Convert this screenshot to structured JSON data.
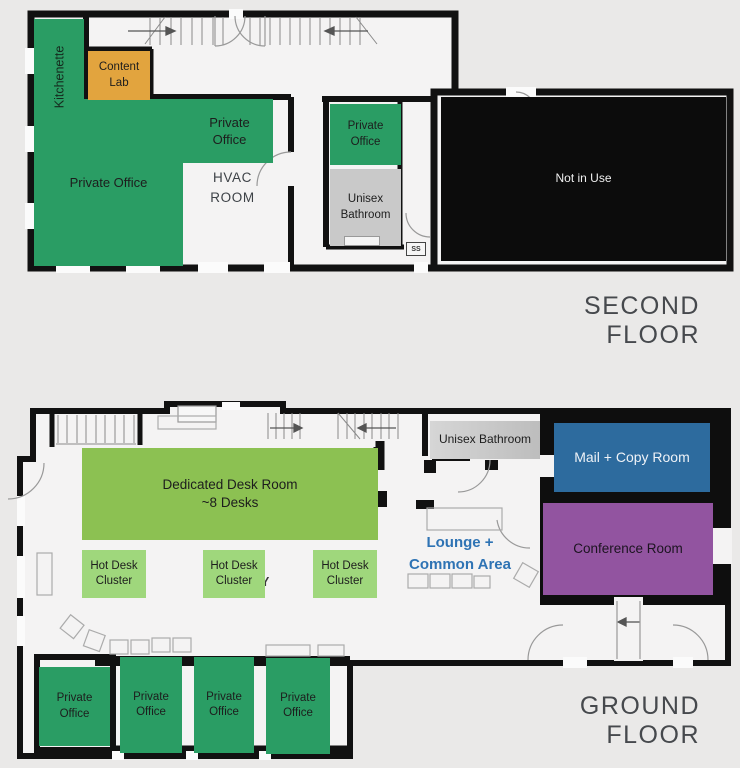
{
  "page": {
    "background_color": "#eae9e8",
    "floor_plan_type": "office floor plan"
  },
  "second_floor": {
    "title": "SECOND FLOOR",
    "rooms": {
      "kitchenette": {
        "label": "Kitchenette",
        "fill": "#2a9d64"
      },
      "private_office_large": {
        "label": "Private Office",
        "fill": "#2a9d64"
      },
      "content_lab": {
        "label": "Content Lab",
        "fill": "#e2a43e"
      },
      "private_office_middle": {
        "label": "Private Office",
        "fill": "#2a9d64"
      },
      "hvac_room": {
        "label": "HVAC ROOM"
      },
      "private_office_small": {
        "label": "Private Office",
        "fill": "#2a9d64"
      },
      "unisex_bathroom": {
        "label": "Unisex Bathroom",
        "fill": "#c9c9c9"
      },
      "service_shaft": {
        "label": "SS"
      },
      "not_in_use": {
        "label": "Not in Use",
        "fill": "#0c0c0c",
        "text_color": "#f0f0f0"
      }
    }
  },
  "ground_floor": {
    "title": "GROUND FLOOR",
    "rooms": {
      "dedicated_desk_room": {
        "label": "Dedicated Desk Room",
        "sublabel": "~8 Desks",
        "fill": "#8cc152"
      },
      "hot_desk_cluster_1": {
        "label": "Hot Desk Cluster",
        "fill": "#9fd77c"
      },
      "hot_desk_cluster_2": {
        "label": "Hot Desk Cluster",
        "fill": "#9fd77c"
      },
      "hot_desk_cluster_3": {
        "label": "Hot Desk Cluster",
        "fill": "#9fd77c"
      },
      "occluded_text": {
        "line1": "l",
        "line2": "Y"
      },
      "unisex_bathroom": {
        "label": "Unisex Bathroom"
      },
      "mail_copy_room": {
        "label": "Mail + Copy Room",
        "fill": "#2d6b9e",
        "text_color": "#eef2f7"
      },
      "conference_room": {
        "label": "Conference Room",
        "fill": "#9254a0",
        "text_color": "#1c1420"
      },
      "lounge_common_area": {
        "line1": "Lounge +",
        "line2": "Common Area",
        "text_color": "#2e73b4"
      },
      "private_office_1": {
        "label": "Private Office",
        "fill": "#2a9d64"
      },
      "private_office_2": {
        "label": "Private Office",
        "fill": "#2a9d64"
      },
      "private_office_3": {
        "label": "Private Office",
        "fill": "#2a9d64"
      },
      "private_office_4": {
        "label": "Private Office",
        "fill": "#2a9d64"
      }
    }
  }
}
